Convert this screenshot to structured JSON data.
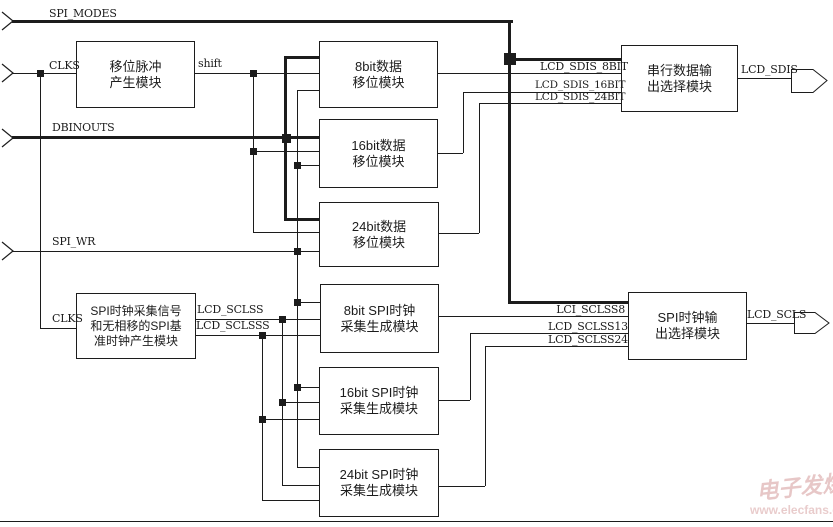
{
  "labels": {
    "spi_modes": "SPI_MODES",
    "clks": "CLKS",
    "clks2": "CLKS",
    "shift": "shift",
    "dbinouts": "DBINOUTS",
    "spi_wr": "SPI_WR",
    "lcd_sclss": "LCD_SCLSS",
    "lcd_sclsss": "LCD_SCLSSS",
    "lcd_sdis_8bit": "LCD_SDIS_8BIT",
    "lcd_sdis_16bit": "LCD_SDIS_16BIT",
    "lcd_sdis_24bit": "LCD_SDIS_24BIT",
    "lcd_sdis": "LCD_SDIS",
    "lci_sclss8": "LCI_SCLSS8",
    "lcd_sclss13": "LCD_SCLSS13",
    "lcd_sclss24": "LCD_SCLSS24",
    "lcd_scls": "LCD_SCLS"
  },
  "modules": {
    "shift_pulse": {
      "lines": [
        "移位脉冲",
        "产生模块"
      ]
    },
    "data8": {
      "lines": [
        "8bit数据",
        "移位模块"
      ]
    },
    "data16": {
      "lines": [
        "16bit数据",
        "移位模块"
      ]
    },
    "data24": {
      "lines": [
        "24bit数据",
        "移位模块"
      ]
    },
    "clk_base": {
      "lines": [
        "SPI时钟采集信号",
        "和无相移的SPI基",
        "准时钟产生模块"
      ]
    },
    "clk8": {
      "lines": [
        "8bit SPI时钟",
        "采集生成模块"
      ]
    },
    "clk16": {
      "lines": [
        "16bit SPI时钟",
        "采集生成模块"
      ]
    },
    "clk24": {
      "lines": [
        "24bit SPI时钟",
        "采集生成模块"
      ]
    },
    "serial_out_select": {
      "lines": [
        "串行数据输",
        "出选择模块"
      ]
    },
    "clock_out_select": {
      "lines": [
        "SPI时钟输",
        "出选择模块"
      ]
    }
  },
  "watermark": {
    "brand": "电子发烧友",
    "site": "www.elecfans.com"
  },
  "colors": {
    "line": "#1c1c1c",
    "background": "#ffffff",
    "watermark": "#d49a9a"
  }
}
